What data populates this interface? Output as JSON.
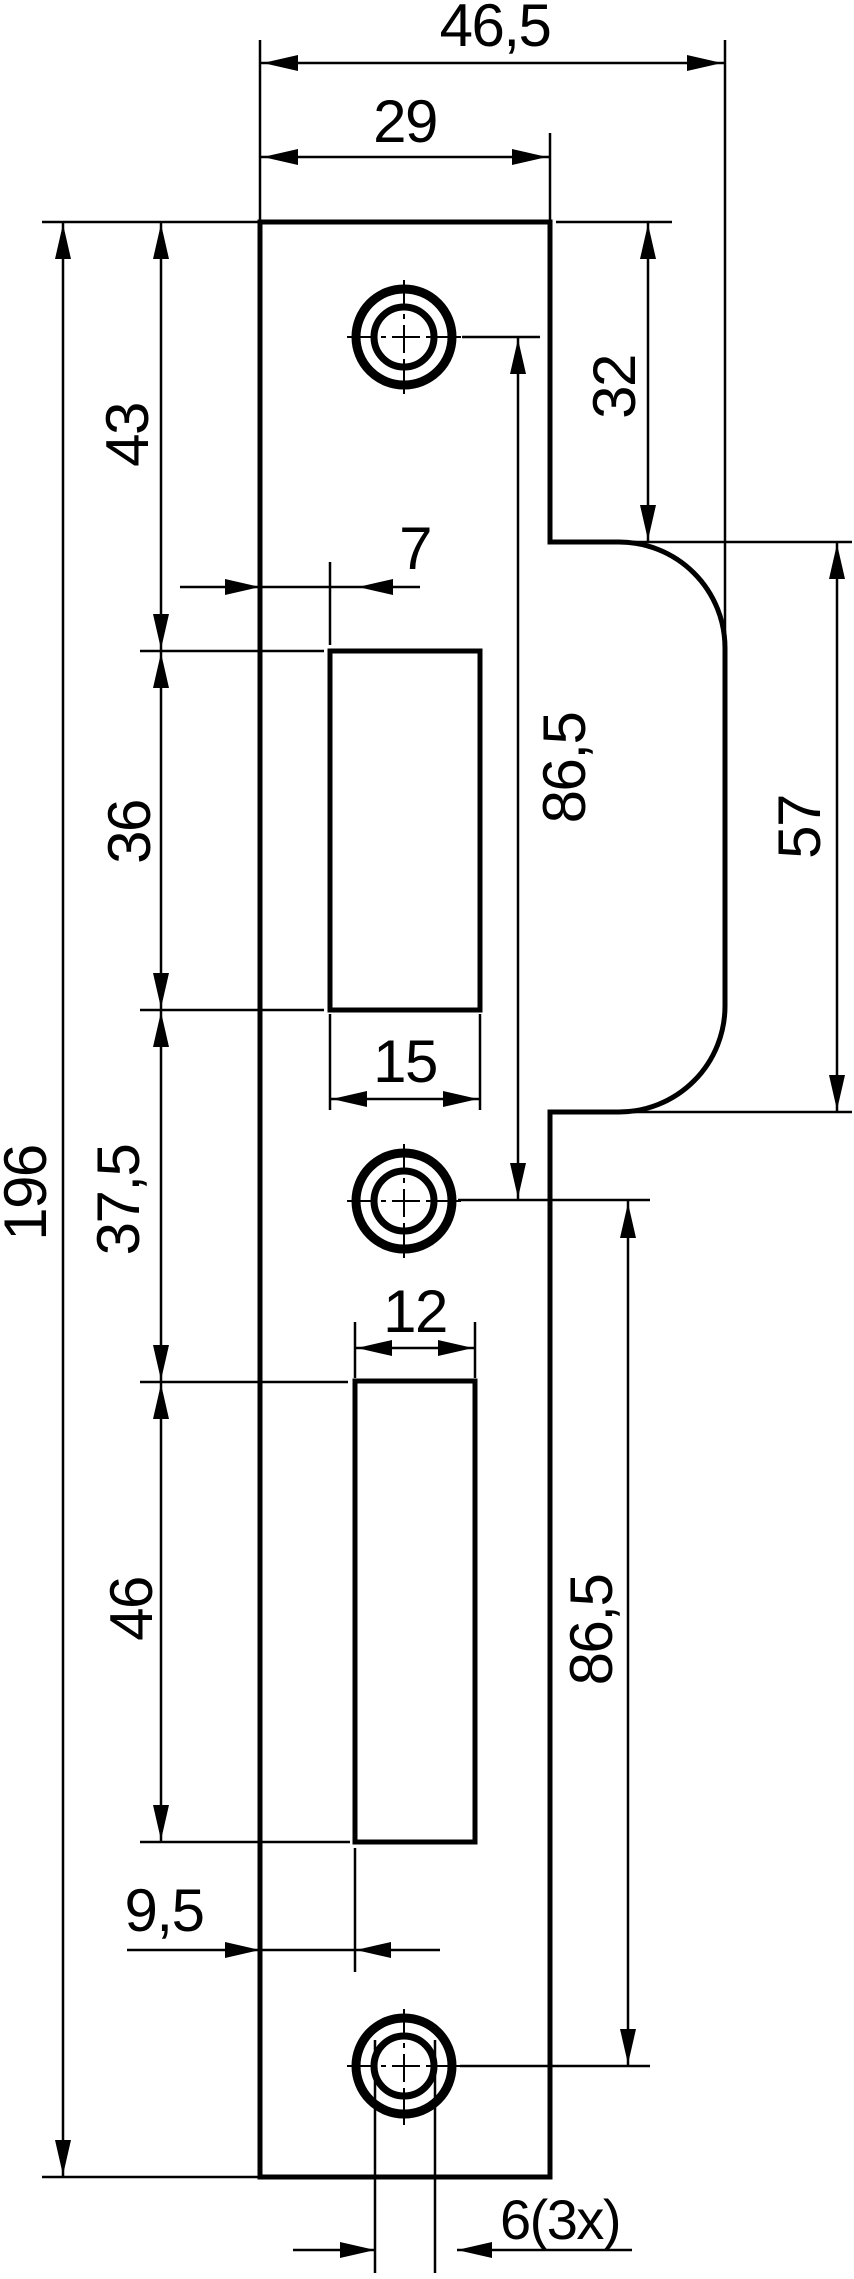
{
  "drawing": {
    "kind": "dimensioned technical drawing",
    "part": "door strike plate, front view with lip, two latch cutouts and three screw holes",
    "units": "mm",
    "line_color": "#000000",
    "background_color": "#ffffff"
  },
  "dimensions": {
    "total_width": "46,5",
    "body_width": "29",
    "total_length": "196",
    "top_edge_to_first_cutout": "43",
    "first_cutout_length": "36",
    "first_cutout_width": "15",
    "first_cutout_offset_from_left": "7",
    "between_cutouts": "37,5",
    "second_cutout_length": "46",
    "second_cutout_width": "12",
    "second_cutout_offset_from_left": "9,5",
    "top_edge_to_lip": "32",
    "lip_length": "57",
    "hole_spacing_upper": "86,5",
    "hole_spacing_lower": "86,5",
    "hole_diameter_and_count": "6(3x)"
  },
  "labels": [
    {
      "id": "total-width",
      "text": "46,5"
    },
    {
      "id": "body-width",
      "text": "29"
    },
    {
      "id": "top-to-cutout1",
      "text": "43"
    },
    {
      "id": "top-to-lip",
      "text": "32"
    },
    {
      "id": "cutout1-offset",
      "text": "7"
    },
    {
      "id": "cutout1-length",
      "text": "36"
    },
    {
      "id": "hole-spacing-upper",
      "text": "86,5"
    },
    {
      "id": "lip-length",
      "text": "57"
    },
    {
      "id": "cutout1-width",
      "text": "15"
    },
    {
      "id": "between-cutouts",
      "text": "37,5"
    },
    {
      "id": "total-length",
      "text": "196"
    },
    {
      "id": "cutout2-width",
      "text": "12"
    },
    {
      "id": "cutout2-length",
      "text": "46"
    },
    {
      "id": "hole-spacing-lower",
      "text": "86,5"
    },
    {
      "id": "cutout2-offset",
      "text": "9,5"
    },
    {
      "id": "hole-diameter",
      "text": "6(3x)"
    }
  ]
}
